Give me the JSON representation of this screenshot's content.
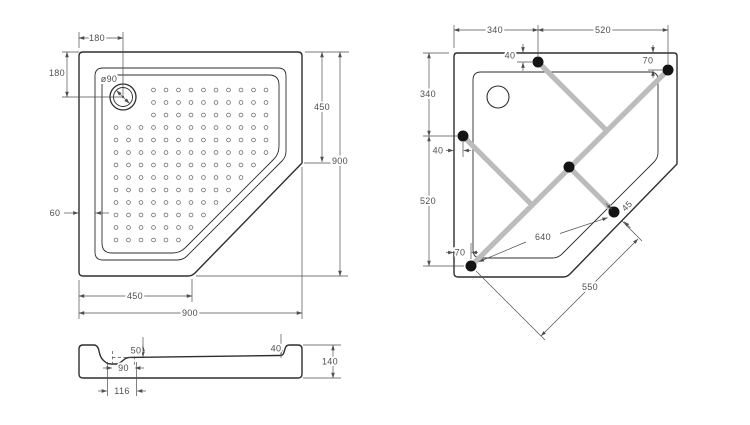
{
  "title": "Pentagonal shower tray technical drawing",
  "colors": {
    "background": "#ffffff",
    "outline": "#2e2e2e",
    "dim_lines": "#4f4f4f",
    "support_bar": "#bcbcbc",
    "foot": "#141414"
  },
  "views": {
    "plan": {
      "drain_label": "ø90",
      "dims": {
        "top_offset": "180",
        "left_offset": "180",
        "right_edge": "450",
        "right_total": "900",
        "rim_width": "60",
        "bottom_edge": "450",
        "bottom_total": "900"
      }
    },
    "install": {
      "dims": {
        "top_left": "340",
        "top_right": "520",
        "foot_top_offset": "40",
        "foot_topright_offset": "70",
        "side_top": "340",
        "foot_left_offset": "40",
        "side_bottom": "520",
        "foot_right_offset": "45",
        "foot_span_long": "640",
        "foot_bottom_offset": "70",
        "foot_span_diag": "550"
      }
    },
    "section": {
      "dims": {
        "depth_left": "50",
        "step_right": "40",
        "height": "140",
        "drain_width": "90",
        "recess_width": "116"
      }
    }
  }
}
